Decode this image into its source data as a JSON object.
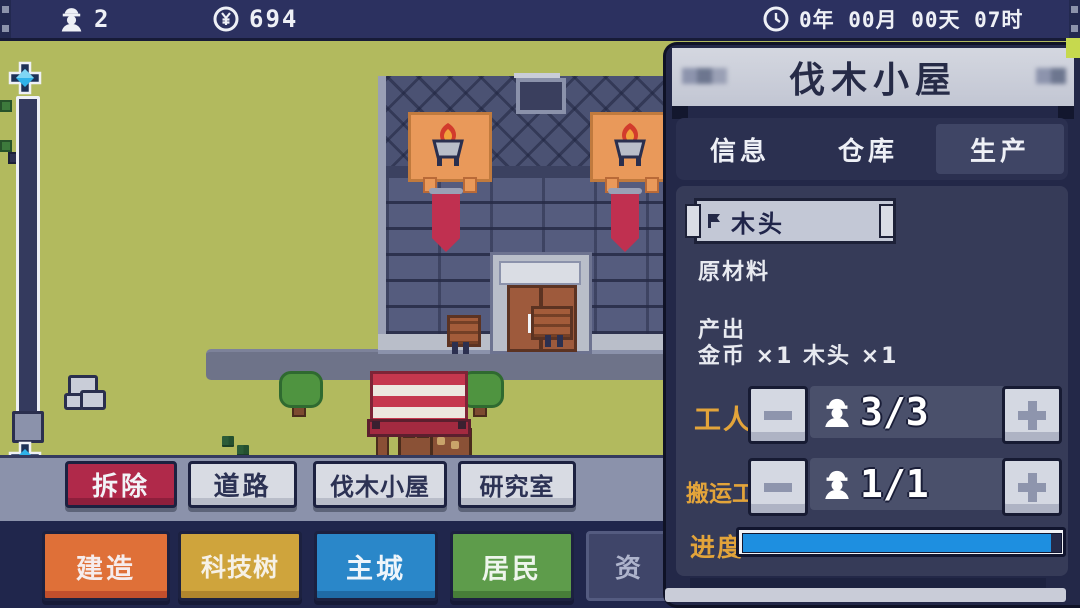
{
  "topbar": {
    "population": "2",
    "gold": "694",
    "time": "0年 00月 00天 07时"
  },
  "panel": {
    "title": "伐木小屋",
    "tabs": [
      {
        "label": "信息",
        "active": false
      },
      {
        "label": "仓库",
        "active": false
      },
      {
        "label": "生产",
        "active": true
      }
    ],
    "production": {
      "item_selector": {
        "value": "木头"
      },
      "category": "原材料",
      "output_label": "产出",
      "output_value": "金币 ×1 木头 ×1",
      "workers": {
        "label": "工人",
        "count": "3/3"
      },
      "porters": {
        "label": "搬运工",
        "count": "1/1"
      },
      "progress": {
        "label": "进度",
        "percent": 97
      }
    }
  },
  "build_toolbar": {
    "buttons": [
      {
        "label": "拆除",
        "style": "red"
      },
      {
        "label": "道路",
        "style": "light"
      },
      {
        "label": "伐木小屋",
        "style": "light"
      },
      {
        "label": "研究室",
        "style": "light"
      }
    ]
  },
  "menu_toolbar": {
    "buttons": [
      {
        "label": "建造",
        "color": "#df7038"
      },
      {
        "label": "科技树",
        "color": "#cfa43c"
      },
      {
        "label": "主城",
        "color": "#2a87c9"
      },
      {
        "label": "居民",
        "color": "#5e9c4b"
      },
      {
        "label": "资",
        "color": "#3f4569"
      }
    ]
  },
  "icons": {
    "population": "worker-with-hard-hat",
    "currency": "yen-coin",
    "time": "clock",
    "scroll_up": "cross-arrow-up",
    "scroll_down": "cross-arrow-down",
    "item_flag": "flag",
    "worker_avatar": "worker-with-hard-hat",
    "decrease": "minus",
    "increase": "plus"
  },
  "colors": {
    "topbar_bg": "#2c3160",
    "grass": "#b2ba5e",
    "road": "#6e7389",
    "panel_frame": "#232848",
    "panel_content": "#363b58",
    "header_bg": "#c9ccd8",
    "accent_gold": "#e3a43a",
    "progress_blue": "#1e8fe0",
    "danger_red": "#b0294a",
    "lime_corner": "#c6d94e"
  }
}
